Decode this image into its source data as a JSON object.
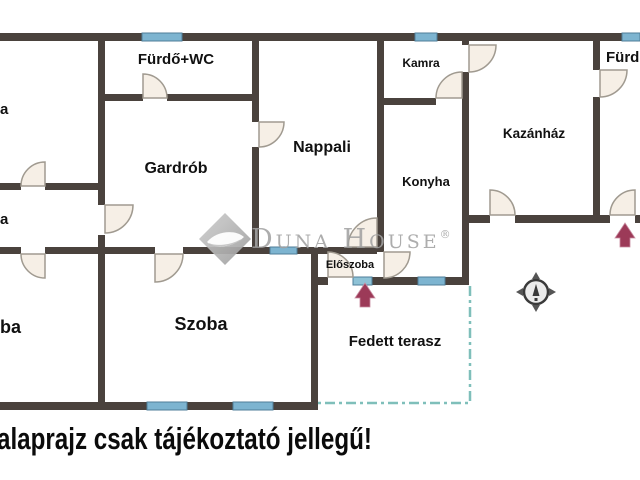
{
  "floorplan": {
    "rooms": [
      {
        "label": "Fürdő+WC"
      },
      {
        "label": "Kamra"
      },
      {
        "label": "Fürdő"
      },
      {
        "label": "Gardrób"
      },
      {
        "label": "Nappali"
      },
      {
        "label": "Konyha"
      },
      {
        "label": "Kazánház"
      },
      {
        "label": "Előszoba"
      },
      {
        "label": "Szoba"
      },
      {
        "label": "Fedett terasz"
      }
    ],
    "partial_labels": [
      {
        "label": "a"
      },
      {
        "label": "a"
      },
      {
        "label": "ba"
      }
    ],
    "features": {
      "entrance_arrows": 2,
      "compass": "compass-rose",
      "terrace_boundary": "dash-dot outline",
      "windows_count": 8,
      "door_arcs_count": 14
    },
    "colors": {
      "wall": "#4a423d",
      "window_fill": "#7db4d0",
      "window_border": "#4f7e99",
      "door_fill": "#f6efe6",
      "door_stroke": "#a09a90",
      "terrace_dash": "#7fbfba",
      "entrance_arrow": "#9c3a58",
      "watermark_gray": "#a2a2a2",
      "text": "#111111",
      "background": "#ffffff"
    }
  },
  "watermark": {
    "brand": "Duna House",
    "registered": "®"
  },
  "disclaimer": "alaprajz csak tájékoztató jellegű!"
}
